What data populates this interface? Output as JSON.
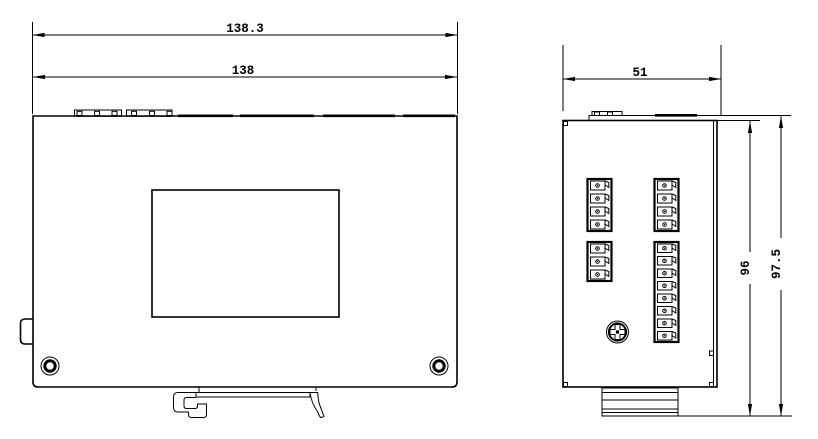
{
  "drawing": {
    "dimensions": {
      "front_overall_width": "138.3",
      "front_body_width": "138",
      "side_depth": "51",
      "side_body_height": "96",
      "side_overall_height": "97.5"
    },
    "colors": {
      "line": "#000000",
      "background": "#ffffff"
    }
  }
}
